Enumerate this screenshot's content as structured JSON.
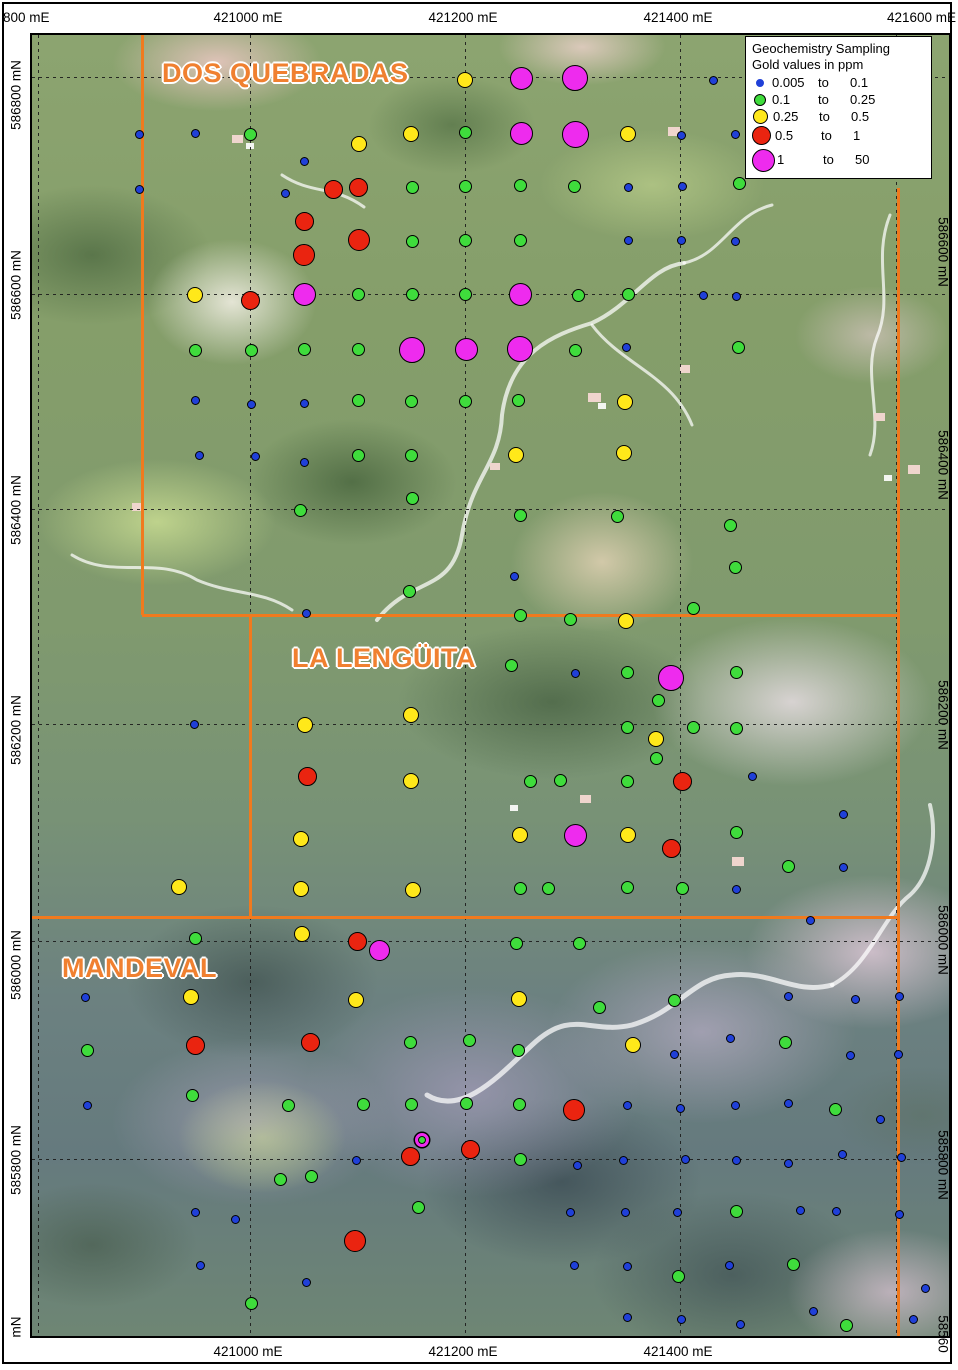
{
  "colors": {
    "boundary_orange": "#f07a1e",
    "label_orange": "#f08030",
    "dot_blue": "#2040d8",
    "dot_green": "#3fdc3c",
    "dot_yellow": "#ffe81a",
    "dot_red": "#ea2410",
    "dot_magenta": "#ee2bee"
  },
  "legend": {
    "title": "Geochemistry Sampling",
    "subtitle": "Gold values in ppm",
    "classes": [
      {
        "swatch": "b",
        "from": "0.005",
        "to_word": "to",
        "to": "0.1"
      },
      {
        "swatch": "g",
        "from": "0.1",
        "to_word": "to",
        "to": "0.25"
      },
      {
        "swatch": "y",
        "from": "0.25",
        "to_word": "to",
        "to": "0.5"
      },
      {
        "swatch": "r",
        "from": "0.5",
        "to_word": "to",
        "to": "1"
      },
      {
        "swatch": "m",
        "from": "1",
        "to_word": "to",
        "to": "50"
      }
    ]
  },
  "axes": {
    "top": [
      {
        "text": "800 mE",
        "x": 3,
        "align": "left"
      },
      {
        "text": "421000 mE",
        "x": 248,
        "align": "center"
      },
      {
        "text": "421200 mE",
        "x": 463,
        "align": "center"
      },
      {
        "text": "421400 mE",
        "x": 678,
        "align": "center"
      },
      {
        "text": "421600 mE",
        "x": 956,
        "align": "right"
      }
    ],
    "bottom": [
      {
        "text": "421000 mE",
        "x": 248,
        "align": "center"
      },
      {
        "text": "421200 mE",
        "x": 463,
        "align": "center"
      },
      {
        "text": "421400 mE",
        "x": 678,
        "align": "center"
      }
    ],
    "left": [
      {
        "text": "586800 mN",
        "y": 95
      },
      {
        "text": "586600 mN",
        "y": 285
      },
      {
        "text": "586400 mN",
        "y": 510
      },
      {
        "text": "586200 mN",
        "y": 730
      },
      {
        "text": "586000 mN",
        "y": 965
      },
      {
        "text": "585800 mN",
        "y": 1160
      },
      {
        "text": "mN",
        "y": 1327
      }
    ],
    "right": [
      {
        "text": "586600 mN",
        "y": 252
      },
      {
        "text": "586400 mN",
        "y": 465
      },
      {
        "text": "586200 mN",
        "y": 715
      },
      {
        "text": "586000 mN",
        "y": 940
      },
      {
        "text": "585800 mN",
        "y": 1165
      },
      {
        "text": "58560",
        "y": 1334
      }
    ]
  },
  "map": {
    "area_labels": [
      {
        "text": "DOS QUEBRADAS",
        "x": 160,
        "y": 56
      },
      {
        "text": "LA LENGÜITA",
        "x": 290,
        "y": 641
      },
      {
        "text": "MANDEVAL",
        "x": 60,
        "y": 951
      }
    ],
    "gridlines": {
      "v": [
        36,
        248,
        463,
        678,
        894
      ],
      "h": [
        75,
        292,
        507,
        722,
        939,
        1157
      ]
    },
    "boundaries": [
      {
        "x1": 140,
        "y1": 33,
        "x2": 140,
        "y2": 613
      },
      {
        "x1": 140,
        "y1": 613,
        "x2": 896,
        "y2": 613
      },
      {
        "x1": 248,
        "y1": 613,
        "x2": 248,
        "y2": 915
      },
      {
        "x1": 30,
        "y1": 915,
        "x2": 896,
        "y2": 915
      },
      {
        "x1": 896,
        "y1": 186,
        "x2": 896,
        "y2": 1338
      }
    ],
    "dot_radius": {
      "b": 4.5,
      "g": 6.5,
      "y": 8,
      "r": 9.5,
      "m": 11.5,
      "s": 7
    },
    "samples": [
      {
        "x": 463,
        "y": 78,
        "c": "y"
      },
      {
        "x": 519,
        "y": 76,
        "c": "m"
      },
      {
        "x": 573,
        "y": 76,
        "c": "m",
        "r": 13
      },
      {
        "x": 711,
        "y": 78,
        "c": "b"
      },
      {
        "x": 137,
        "y": 132,
        "c": "b"
      },
      {
        "x": 193,
        "y": 131,
        "c": "b"
      },
      {
        "x": 248,
        "y": 132,
        "c": "g"
      },
      {
        "x": 357,
        "y": 142,
        "c": "y"
      },
      {
        "x": 409,
        "y": 132,
        "c": "y"
      },
      {
        "x": 463,
        "y": 130,
        "c": "g"
      },
      {
        "x": 519,
        "y": 131,
        "c": "m"
      },
      {
        "x": 573,
        "y": 132,
        "c": "m",
        "r": 13.5
      },
      {
        "x": 626,
        "y": 132,
        "c": "y"
      },
      {
        "x": 679,
        "y": 133,
        "c": "b"
      },
      {
        "x": 733,
        "y": 132,
        "c": "b"
      },
      {
        "x": 302,
        "y": 159,
        "c": "b"
      },
      {
        "x": 137,
        "y": 187,
        "c": "b"
      },
      {
        "x": 283,
        "y": 191,
        "c": "b"
      },
      {
        "x": 331,
        "y": 187,
        "c": "r"
      },
      {
        "x": 356,
        "y": 185,
        "c": "r"
      },
      {
        "x": 410,
        "y": 185,
        "c": "g"
      },
      {
        "x": 463,
        "y": 184,
        "c": "g"
      },
      {
        "x": 518,
        "y": 183,
        "c": "g"
      },
      {
        "x": 572,
        "y": 184,
        "c": "g"
      },
      {
        "x": 626,
        "y": 185,
        "c": "b"
      },
      {
        "x": 680,
        "y": 184,
        "c": "b"
      },
      {
        "x": 737,
        "y": 181,
        "c": "g"
      },
      {
        "x": 302,
        "y": 219,
        "c": "r"
      },
      {
        "x": 357,
        "y": 238,
        "c": "r",
        "r": 11
      },
      {
        "x": 410,
        "y": 239,
        "c": "g"
      },
      {
        "x": 463,
        "y": 238,
        "c": "g"
      },
      {
        "x": 518,
        "y": 238,
        "c": "g"
      },
      {
        "x": 626,
        "y": 238,
        "c": "b"
      },
      {
        "x": 679,
        "y": 238,
        "c": "b"
      },
      {
        "x": 733,
        "y": 239,
        "c": "b"
      },
      {
        "x": 302,
        "y": 253,
        "c": "r",
        "r": 11
      },
      {
        "x": 193,
        "y": 293,
        "c": "y"
      },
      {
        "x": 248,
        "y": 298,
        "c": "r"
      },
      {
        "x": 302,
        "y": 292,
        "c": "m"
      },
      {
        "x": 356,
        "y": 292,
        "c": "g"
      },
      {
        "x": 410,
        "y": 292,
        "c": "g"
      },
      {
        "x": 463,
        "y": 292,
        "c": "g"
      },
      {
        "x": 518,
        "y": 292,
        "c": "m"
      },
      {
        "x": 576,
        "y": 293,
        "c": "g"
      },
      {
        "x": 626,
        "y": 292,
        "c": "g"
      },
      {
        "x": 701,
        "y": 293,
        "c": "b"
      },
      {
        "x": 734,
        "y": 294,
        "c": "b"
      },
      {
        "x": 193,
        "y": 348,
        "c": "g"
      },
      {
        "x": 249,
        "y": 348,
        "c": "g"
      },
      {
        "x": 302,
        "y": 347,
        "c": "g"
      },
      {
        "x": 356,
        "y": 347,
        "c": "g"
      },
      {
        "x": 410,
        "y": 348,
        "c": "m",
        "r": 13
      },
      {
        "x": 464,
        "y": 347,
        "c": "m"
      },
      {
        "x": 518,
        "y": 347,
        "c": "m",
        "r": 13
      },
      {
        "x": 573,
        "y": 348,
        "c": "g"
      },
      {
        "x": 624,
        "y": 345,
        "c": "b"
      },
      {
        "x": 736,
        "y": 345,
        "c": "g"
      },
      {
        "x": 193,
        "y": 398,
        "c": "b"
      },
      {
        "x": 249,
        "y": 402,
        "c": "b"
      },
      {
        "x": 302,
        "y": 401,
        "c": "b"
      },
      {
        "x": 356,
        "y": 398,
        "c": "g"
      },
      {
        "x": 409,
        "y": 399,
        "c": "g"
      },
      {
        "x": 463,
        "y": 399,
        "c": "g"
      },
      {
        "x": 516,
        "y": 398,
        "c": "g"
      },
      {
        "x": 623,
        "y": 400,
        "c": "y"
      },
      {
        "x": 197,
        "y": 453,
        "c": "b"
      },
      {
        "x": 253,
        "y": 454,
        "c": "b"
      },
      {
        "x": 302,
        "y": 460,
        "c": "b"
      },
      {
        "x": 356,
        "y": 453,
        "c": "g"
      },
      {
        "x": 409,
        "y": 453,
        "c": "g"
      },
      {
        "x": 514,
        "y": 453,
        "c": "y"
      },
      {
        "x": 622,
        "y": 451,
        "c": "y"
      },
      {
        "x": 410,
        "y": 496,
        "c": "g"
      },
      {
        "x": 298,
        "y": 508,
        "c": "g"
      },
      {
        "x": 518,
        "y": 513,
        "c": "g"
      },
      {
        "x": 615,
        "y": 514,
        "c": "g"
      },
      {
        "x": 728,
        "y": 523,
        "c": "g"
      },
      {
        "x": 733,
        "y": 565,
        "c": "g"
      },
      {
        "x": 512,
        "y": 574,
        "c": "b"
      },
      {
        "x": 407,
        "y": 589,
        "c": "g"
      },
      {
        "x": 304,
        "y": 611,
        "c": "b"
      },
      {
        "x": 518,
        "y": 613,
        "c": "g"
      },
      {
        "x": 568,
        "y": 617,
        "c": "g"
      },
      {
        "x": 624,
        "y": 619,
        "c": "y"
      },
      {
        "x": 691,
        "y": 606,
        "c": "g"
      },
      {
        "x": 509,
        "y": 663,
        "c": "g"
      },
      {
        "x": 573,
        "y": 671,
        "c": "b"
      },
      {
        "x": 625,
        "y": 670,
        "c": "g"
      },
      {
        "x": 669,
        "y": 676,
        "c": "m",
        "r": 13
      },
      {
        "x": 734,
        "y": 670,
        "c": "g"
      },
      {
        "x": 656,
        "y": 698,
        "c": "g"
      },
      {
        "x": 409,
        "y": 713,
        "c": "y"
      },
      {
        "x": 192,
        "y": 722,
        "c": "b"
      },
      {
        "x": 303,
        "y": 723,
        "c": "y"
      },
      {
        "x": 625,
        "y": 725,
        "c": "g"
      },
      {
        "x": 691,
        "y": 725,
        "c": "g"
      },
      {
        "x": 734,
        "y": 726,
        "c": "g"
      },
      {
        "x": 654,
        "y": 737,
        "c": "y"
      },
      {
        "x": 654,
        "y": 756,
        "c": "g"
      },
      {
        "x": 305,
        "y": 774,
        "c": "r"
      },
      {
        "x": 409,
        "y": 779,
        "c": "y"
      },
      {
        "x": 528,
        "y": 779,
        "c": "g"
      },
      {
        "x": 558,
        "y": 778,
        "c": "g"
      },
      {
        "x": 625,
        "y": 779,
        "c": "g"
      },
      {
        "x": 680,
        "y": 779,
        "c": "r"
      },
      {
        "x": 750,
        "y": 774,
        "c": "b"
      },
      {
        "x": 841,
        "y": 812,
        "c": "b"
      },
      {
        "x": 299,
        "y": 837,
        "c": "y"
      },
      {
        "x": 518,
        "y": 833,
        "c": "y"
      },
      {
        "x": 573,
        "y": 833,
        "c": "m"
      },
      {
        "x": 626,
        "y": 833,
        "c": "y"
      },
      {
        "x": 734,
        "y": 830,
        "c": "g"
      },
      {
        "x": 669,
        "y": 846,
        "c": "r"
      },
      {
        "x": 786,
        "y": 864,
        "c": "g"
      },
      {
        "x": 841,
        "y": 865,
        "c": "b"
      },
      {
        "x": 177,
        "y": 885,
        "c": "y"
      },
      {
        "x": 299,
        "y": 887,
        "c": "y"
      },
      {
        "x": 411,
        "y": 888,
        "c": "y"
      },
      {
        "x": 518,
        "y": 886,
        "c": "g"
      },
      {
        "x": 546,
        "y": 886,
        "c": "g"
      },
      {
        "x": 625,
        "y": 885,
        "c": "g"
      },
      {
        "x": 680,
        "y": 886,
        "c": "g"
      },
      {
        "x": 734,
        "y": 887,
        "c": "b"
      },
      {
        "x": 808,
        "y": 918,
        "c": "b"
      },
      {
        "x": 193,
        "y": 936,
        "c": "g"
      },
      {
        "x": 300,
        "y": 932,
        "c": "y"
      },
      {
        "x": 355,
        "y": 939,
        "c": "r"
      },
      {
        "x": 377,
        "y": 948,
        "c": "m",
        "r": 10.5
      },
      {
        "x": 514,
        "y": 941,
        "c": "g"
      },
      {
        "x": 577,
        "y": 941,
        "c": "g"
      },
      {
        "x": 83,
        "y": 995,
        "c": "b"
      },
      {
        "x": 189,
        "y": 995,
        "c": "y"
      },
      {
        "x": 354,
        "y": 998,
        "c": "y"
      },
      {
        "x": 517,
        "y": 997,
        "c": "y"
      },
      {
        "x": 597,
        "y": 1005,
        "c": "g"
      },
      {
        "x": 672,
        "y": 998,
        "c": "g"
      },
      {
        "x": 786,
        "y": 994,
        "c": "b"
      },
      {
        "x": 853,
        "y": 997,
        "c": "b"
      },
      {
        "x": 897,
        "y": 994,
        "c": "b"
      },
      {
        "x": 85,
        "y": 1048,
        "c": "g"
      },
      {
        "x": 193,
        "y": 1043,
        "c": "r"
      },
      {
        "x": 308,
        "y": 1040,
        "c": "r"
      },
      {
        "x": 408,
        "y": 1040,
        "c": "g"
      },
      {
        "x": 467,
        "y": 1038,
        "c": "g"
      },
      {
        "x": 516,
        "y": 1048,
        "c": "g"
      },
      {
        "x": 631,
        "y": 1043,
        "c": "y"
      },
      {
        "x": 672,
        "y": 1052,
        "c": "b"
      },
      {
        "x": 728,
        "y": 1036,
        "c": "b"
      },
      {
        "x": 783,
        "y": 1040,
        "c": "g"
      },
      {
        "x": 848,
        "y": 1053,
        "c": "b"
      },
      {
        "x": 896,
        "y": 1052,
        "c": "b"
      },
      {
        "x": 85,
        "y": 1103,
        "c": "b"
      },
      {
        "x": 190,
        "y": 1093,
        "c": "g"
      },
      {
        "x": 286,
        "y": 1103,
        "c": "g"
      },
      {
        "x": 361,
        "y": 1102,
        "c": "g"
      },
      {
        "x": 409,
        "y": 1102,
        "c": "g"
      },
      {
        "x": 464,
        "y": 1101,
        "c": "g"
      },
      {
        "x": 517,
        "y": 1102,
        "c": "g"
      },
      {
        "x": 572,
        "y": 1108,
        "c": "r",
        "r": 11
      },
      {
        "x": 625,
        "y": 1103,
        "c": "b"
      },
      {
        "x": 678,
        "y": 1106,
        "c": "b"
      },
      {
        "x": 733,
        "y": 1103,
        "c": "b"
      },
      {
        "x": 786,
        "y": 1101,
        "c": "b"
      },
      {
        "x": 833,
        "y": 1107,
        "c": "g"
      },
      {
        "x": 878,
        "y": 1117,
        "c": "b"
      },
      {
        "x": 420,
        "y": 1138,
        "c": "s"
      },
      {
        "x": 354,
        "y": 1158,
        "c": "b"
      },
      {
        "x": 408,
        "y": 1154,
        "c": "r"
      },
      {
        "x": 468,
        "y": 1147,
        "c": "r"
      },
      {
        "x": 518,
        "y": 1157,
        "c": "g"
      },
      {
        "x": 575,
        "y": 1163,
        "c": "b"
      },
      {
        "x": 621,
        "y": 1158,
        "c": "b"
      },
      {
        "x": 683,
        "y": 1157,
        "c": "b"
      },
      {
        "x": 734,
        "y": 1158,
        "c": "b"
      },
      {
        "x": 786,
        "y": 1161,
        "c": "b"
      },
      {
        "x": 840,
        "y": 1152,
        "c": "b"
      },
      {
        "x": 899,
        "y": 1155,
        "c": "b"
      },
      {
        "x": 278,
        "y": 1177,
        "c": "g"
      },
      {
        "x": 309,
        "y": 1174,
        "c": "g"
      },
      {
        "x": 416,
        "y": 1205,
        "c": "g"
      },
      {
        "x": 193,
        "y": 1210,
        "c": "b"
      },
      {
        "x": 233,
        "y": 1217,
        "c": "b"
      },
      {
        "x": 568,
        "y": 1210,
        "c": "b"
      },
      {
        "x": 623,
        "y": 1210,
        "c": "b"
      },
      {
        "x": 675,
        "y": 1210,
        "c": "b"
      },
      {
        "x": 734,
        "y": 1209,
        "c": "g"
      },
      {
        "x": 798,
        "y": 1208,
        "c": "b"
      },
      {
        "x": 834,
        "y": 1209,
        "c": "b"
      },
      {
        "x": 897,
        "y": 1212,
        "c": "b"
      },
      {
        "x": 353,
        "y": 1239,
        "c": "r",
        "r": 11
      },
      {
        "x": 198,
        "y": 1263,
        "c": "b"
      },
      {
        "x": 304,
        "y": 1280,
        "c": "b"
      },
      {
        "x": 249,
        "y": 1301,
        "c": "g"
      },
      {
        "x": 572,
        "y": 1263,
        "c": "b"
      },
      {
        "x": 625,
        "y": 1264,
        "c": "b"
      },
      {
        "x": 676,
        "y": 1274,
        "c": "g"
      },
      {
        "x": 727,
        "y": 1263,
        "c": "b"
      },
      {
        "x": 791,
        "y": 1262,
        "c": "g"
      },
      {
        "x": 923,
        "y": 1286,
        "c": "b"
      },
      {
        "x": 625,
        "y": 1315,
        "c": "b"
      },
      {
        "x": 679,
        "y": 1317,
        "c": "b"
      },
      {
        "x": 738,
        "y": 1322,
        "c": "b"
      },
      {
        "x": 811,
        "y": 1309,
        "c": "b"
      },
      {
        "x": 844,
        "y": 1323,
        "c": "g"
      },
      {
        "x": 911,
        "y": 1317,
        "c": "b"
      }
    ]
  }
}
